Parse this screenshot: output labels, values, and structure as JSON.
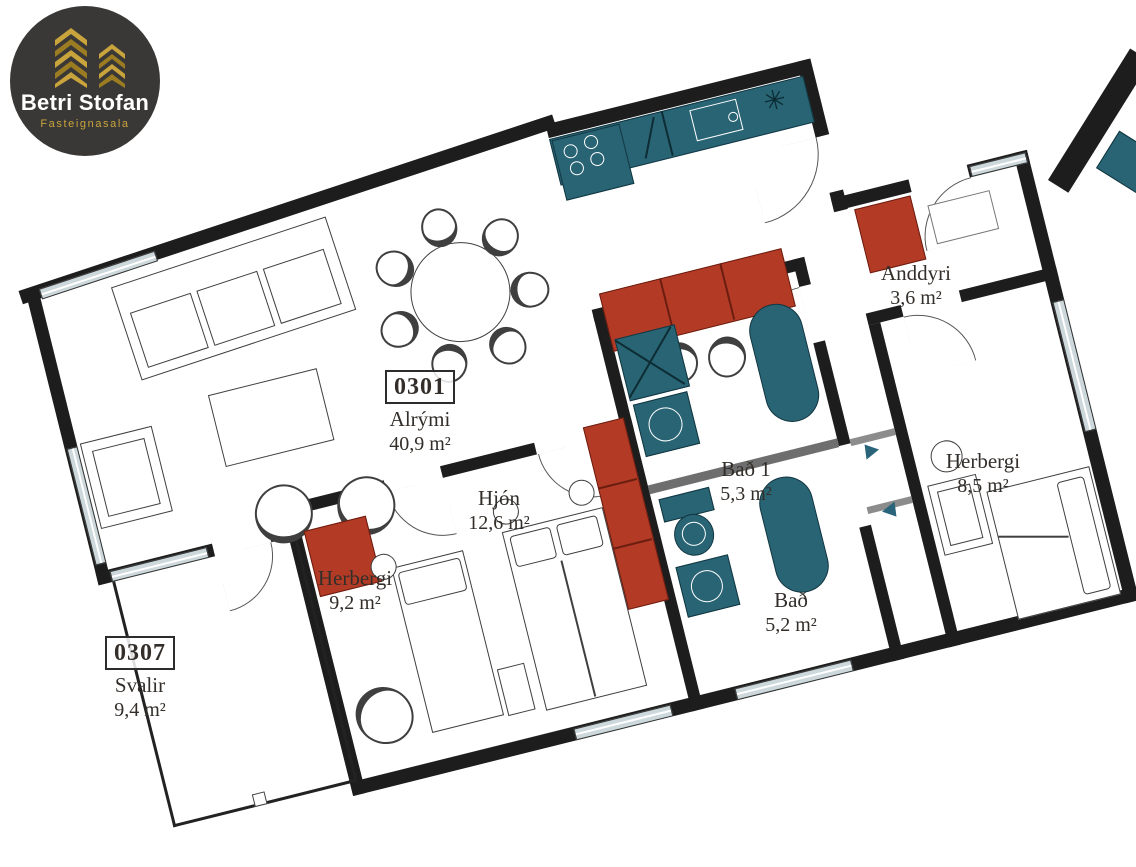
{
  "logo": {
    "brand": "Betri Stofan",
    "tagline": "Fasteignasala"
  },
  "rooms": [
    {
      "unit": "0301",
      "name": "Alrými",
      "area": "40,9 m²"
    },
    {
      "name": "Anddyri",
      "area": "3,6 m²"
    },
    {
      "name": "Herbergi",
      "area": "8,5 m²"
    },
    {
      "name": "Bað 1",
      "area": "5,3 m²"
    },
    {
      "name": "Bað",
      "area": "5,2 m²"
    },
    {
      "name": "Hjón",
      "area": "12,6 m²"
    },
    {
      "name": "Herbergi",
      "area": "9,2 m²"
    },
    {
      "unit": "0307",
      "name": "Svalir",
      "area": "9,4 m²"
    }
  ],
  "symbols": {
    "kitchen_star": "✳"
  },
  "colors": {
    "wall": "#1d1d1d",
    "fixture_teal": "#296474",
    "furniture_red": "#b33b26",
    "window_fill": "#ccd8db",
    "logo_gold": "#c9a43c",
    "logo_background": "#3a3836",
    "label_text": "#332e29"
  }
}
